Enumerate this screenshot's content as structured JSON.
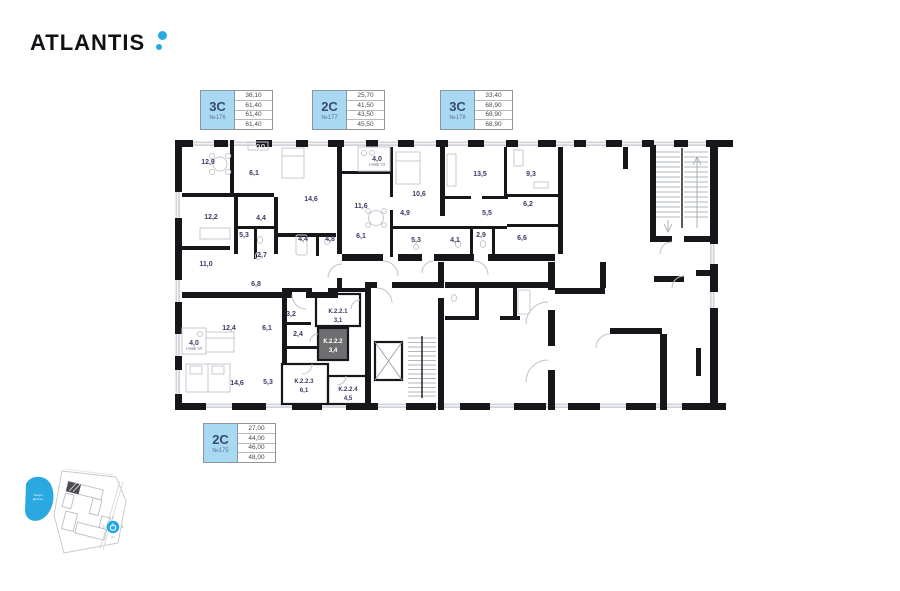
{
  "brand": {
    "name": "ATLANTIS"
  },
  "units": [
    {
      "type": "3С",
      "number": "№176",
      "areas": [
        "36,10",
        "61,40",
        "61,40",
        "61,40"
      ]
    },
    {
      "type": "2С",
      "number": "№177",
      "areas": [
        "25,70",
        "41,50",
        "43,50",
        "45,50"
      ]
    },
    {
      "type": "3С",
      "number": "№178",
      "areas": [
        "33,40",
        "68,90",
        "68,90",
        "68,90"
      ]
    },
    {
      "type": "2С",
      "number": "№175",
      "areas": [
        "27,00",
        "44,00",
        "46,00",
        "48,00"
      ]
    }
  ],
  "plan": {
    "coef_note": "с коэф. 0,5",
    "rooms": [
      {
        "label": "12,9",
        "x": 38,
        "y": 28
      },
      {
        "label": "6,1",
        "x": 84,
        "y": 39
      },
      {
        "label": "12,2",
        "x": 41,
        "y": 83
      },
      {
        "label": "4,4",
        "x": 91,
        "y": 84
      },
      {
        "label": "5,3",
        "x": 74,
        "y": 101
      },
      {
        "label": "2,7",
        "x": 92,
        "y": 121
      },
      {
        "label": "11,0",
        "x": 36,
        "y": 130
      },
      {
        "label": "14,6",
        "x": 141,
        "y": 65
      },
      {
        "label": "4,4",
        "x": 133,
        "y": 105
      },
      {
        "label": "4,8",
        "x": 160,
        "y": 105
      },
      {
        "label": "4,0",
        "x": 207,
        "y": 25,
        "note": true
      },
      {
        "label": "11,6",
        "x": 191,
        "y": 72
      },
      {
        "label": "6,1",
        "x": 191,
        "y": 102
      },
      {
        "label": "10,6",
        "x": 249,
        "y": 60
      },
      {
        "label": "4,9",
        "x": 235,
        "y": 79
      },
      {
        "label": "5,3",
        "x": 246,
        "y": 106
      },
      {
        "label": "13,5",
        "x": 310,
        "y": 40
      },
      {
        "label": "5,5",
        "x": 317,
        "y": 79
      },
      {
        "label": "4,1",
        "x": 285,
        "y": 106
      },
      {
        "label": "2,9",
        "x": 311,
        "y": 101
      },
      {
        "label": "9,3",
        "x": 361,
        "y": 40
      },
      {
        "label": "6,2",
        "x": 358,
        "y": 70
      },
      {
        "label": "6,6",
        "x": 352,
        "y": 104
      },
      {
        "label": "6,8",
        "x": 86,
        "y": 150
      },
      {
        "label": "3,2",
        "x": 121,
        "y": 180
      },
      {
        "label": "2,4",
        "x": 128,
        "y": 200
      },
      {
        "label": "12,4",
        "x": 59,
        "y": 194
      },
      {
        "label": "6,1",
        "x": 97,
        "y": 194
      },
      {
        "label": "4,0",
        "x": 24,
        "y": 209,
        "note": true
      },
      {
        "label": "14,6",
        "x": 67,
        "y": 249
      },
      {
        "label": "5,3",
        "x": 98,
        "y": 248
      }
    ],
    "storages": [
      {
        "name": "К.2.2.1",
        "area": "3,1",
        "x": 168,
        "y": 177
      },
      {
        "name": "К.2.2.2",
        "area": "3,4",
        "x": 163,
        "y": 207,
        "selected": true
      },
      {
        "name": "К.2.2.3",
        "area": "6,1",
        "x": 134,
        "y": 247
      },
      {
        "name": "К.2.2.4",
        "area": "4,5",
        "x": 178,
        "y": 255
      }
    ]
  },
  "minimap": {
    "lake": {
      "line1": "Озеро",
      "line2": "Долгое"
    },
    "compass": {
      "north": "С",
      "east": "В",
      "south": "Ю",
      "west": "З"
    }
  },
  "colors": {
    "accent": "#2aa9e1",
    "card_fill": "#a7d9f2",
    "room_label": "#3e3b63",
    "highlight_cell": "#6e6e70",
    "wall": "#17171b",
    "window": "#cfd4db"
  }
}
